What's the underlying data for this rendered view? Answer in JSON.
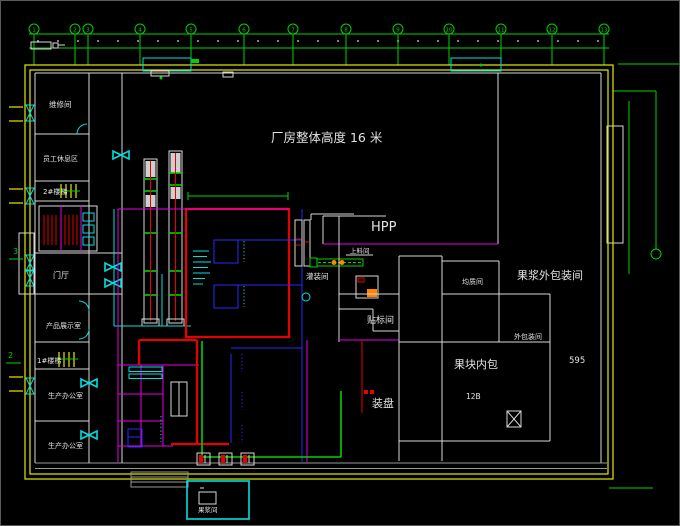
{
  "canvas": {
    "background": "#000000",
    "frame": "#5a5a5a"
  },
  "title": {
    "text": "厂房整体高度 16 米"
  },
  "grid": {
    "cols": [
      "1",
      "2",
      "3",
      "4",
      "5",
      "6",
      "7",
      "8",
      "9",
      "10",
      "11",
      "12",
      "13"
    ]
  },
  "rooms": {
    "maintenance": "维修间",
    "staff_rest": "员工休息区",
    "stair2": "2#楼梯",
    "lobby": "门厅",
    "product_display": "产品展示室",
    "stair1": "1#楼梯",
    "office1": "生产办公室",
    "office2": "生产办公室",
    "filling": "灌装间",
    "feeding": "上料间",
    "hpp": "HPP",
    "labeling": "贴标间",
    "tray": "装盘",
    "homogenize": "均质间",
    "pulp_outer_pack": "果浆外包装间",
    "outer_pack": "外包装间",
    "chunk_inner_pack": "果块内包",
    "pulp_box": "果浆间"
  },
  "annotations": {
    "room_12b": "12B",
    "dim_595": "595",
    "section_marker_3": "3",
    "section_marker_2": "2"
  },
  "colors": {
    "walls_yellow": "#E8E800",
    "grid_green": "#00D200",
    "partition_magenta": "#E800E8",
    "equipment_red": "#E60000",
    "piping_blue": "#2A2AFF",
    "annotation_cyan": "#00E0E0",
    "wall_white": "#D9D9D9",
    "walkway_gray": "#979797",
    "machine_orange": "#FF8400",
    "text_white": "#E2E2E2"
  }
}
